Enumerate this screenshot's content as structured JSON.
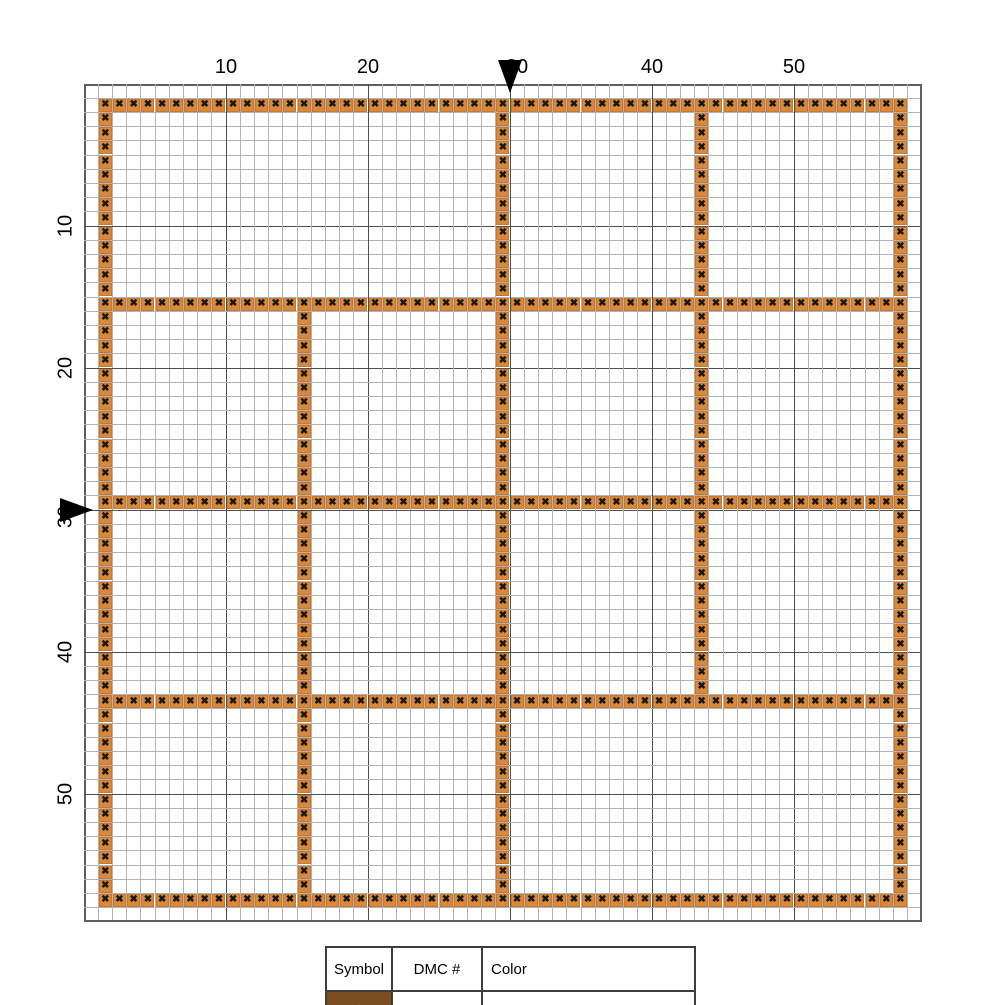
{
  "pattern_chart": {
    "grid": {
      "cells": 59,
      "cell_px": 14.2,
      "origin_x": 84,
      "origin_y": 84,
      "bold_every": 10,
      "thin_line_color": "#b3b3b3",
      "bold_line_color": "#4f4f4f",
      "edge_line_color": "#5f5f5f"
    },
    "axis": {
      "top_ticks": [
        "10",
        "20",
        "30",
        "40",
        "50"
      ],
      "left_ticks": [
        "10",
        "20",
        "30",
        "40",
        "50"
      ],
      "marked_tick": "30",
      "marker_color": "#000000"
    },
    "stitch": {
      "symbol": "✖",
      "symbol_color": "#181818",
      "fill": "#d8893c",
      "border_color": "#c9772e"
    },
    "segments": {
      "horizontal": [
        {
          "row": 2,
          "from": 2,
          "to": 58
        },
        {
          "row": 16,
          "from": 2,
          "to": 58
        },
        {
          "row": 30,
          "from": 2,
          "to": 58
        },
        {
          "row": 44,
          "from": 2,
          "to": 58
        },
        {
          "row": 58,
          "from": 2,
          "to": 58
        }
      ],
      "vertical": [
        {
          "col": 2,
          "from": 2,
          "to": 58
        },
        {
          "col": 16,
          "from": 16,
          "to": 58
        },
        {
          "col": 30,
          "from": 2,
          "to": 58
        },
        {
          "col": 44,
          "from": 2,
          "to": 44
        },
        {
          "col": 58,
          "from": 2,
          "to": 58
        }
      ]
    }
  },
  "legend": {
    "headers": [
      "Symbol",
      "DMC #",
      "Color"
    ],
    "rows": [
      {
        "symbol": "★",
        "symbol_color": "#ffffff",
        "swatch_color": "#7a4e20",
        "dmc": "433",
        "name": "Brown, med"
      }
    ]
  }
}
